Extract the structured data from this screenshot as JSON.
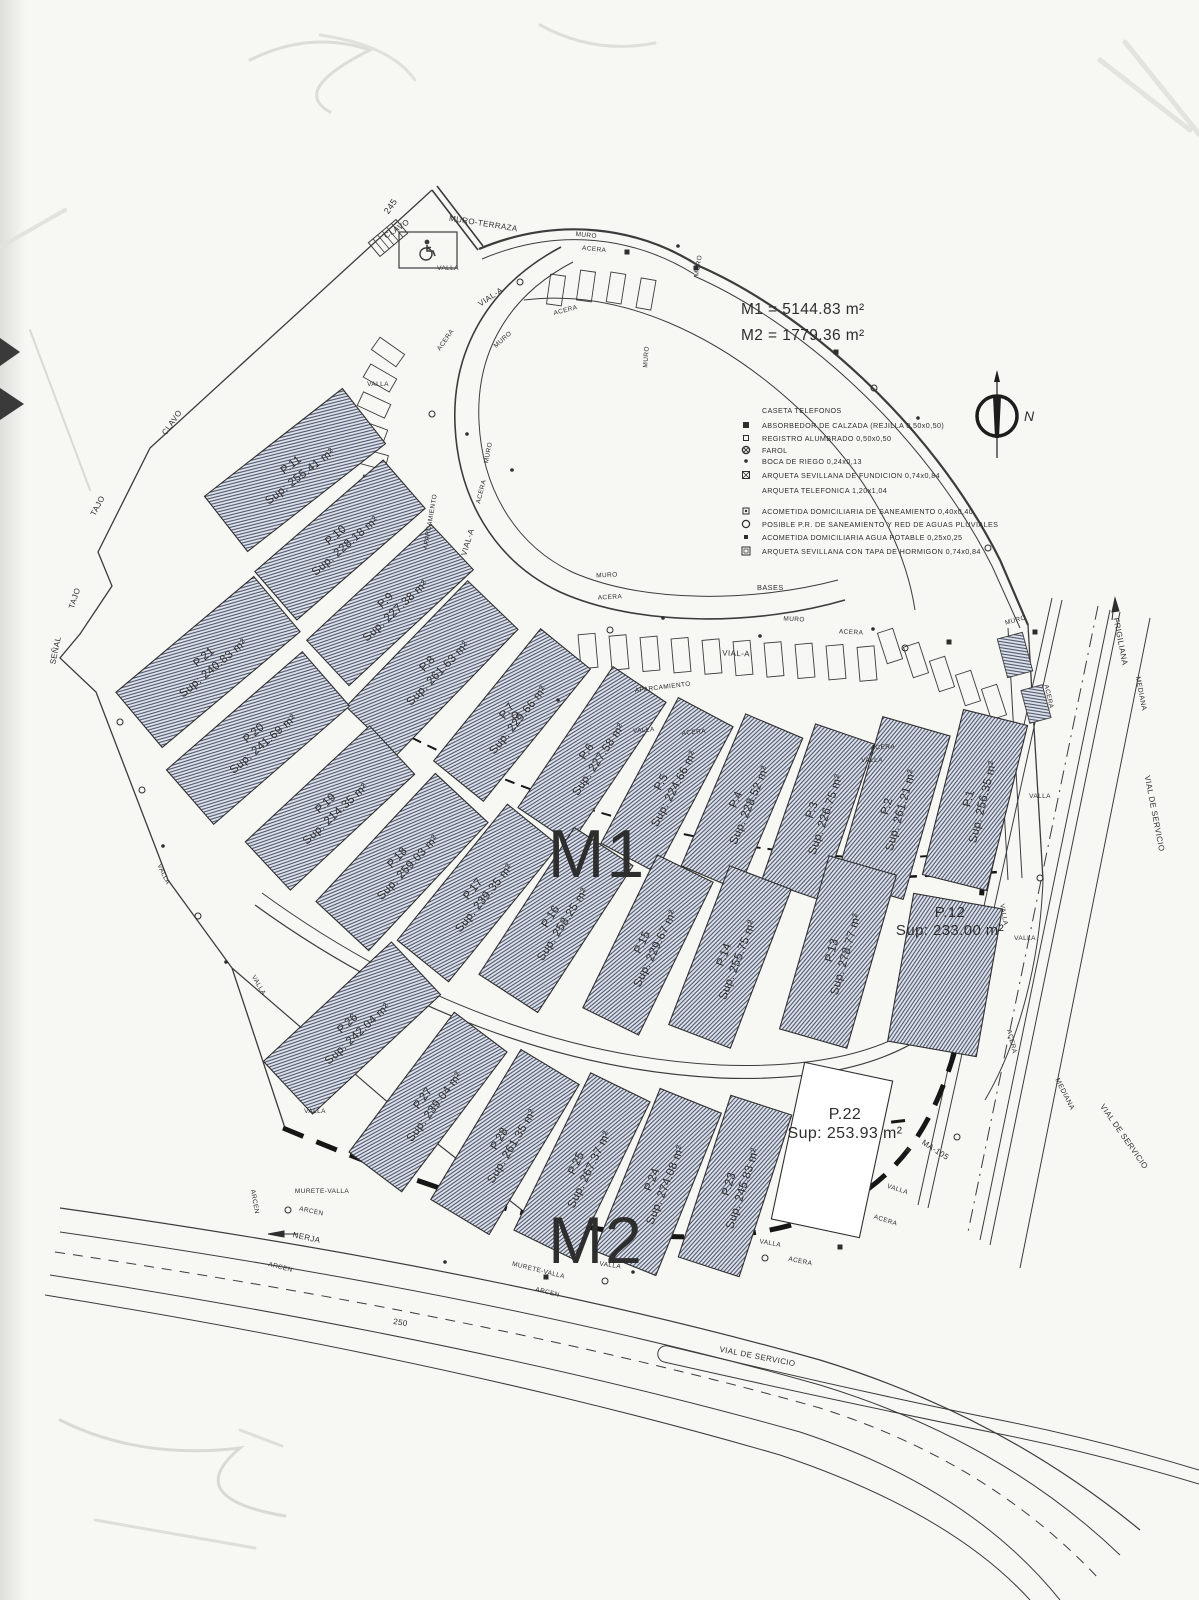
{
  "document": {
    "type_label": "Plano de parcelación (scan)"
  },
  "totals": {
    "m1": "M1 = 5144.83 m²",
    "m2": "M2 = 1779.36 m²"
  },
  "zones": {
    "m1": "M1",
    "m2": "M2"
  },
  "compass": {
    "north_label": "N"
  },
  "legend": {
    "rows": [
      {
        "symbol": "none",
        "label": "CASETA TELEFONOS"
      },
      {
        "symbol": "sq-filled",
        "label": "ABSORBEDOR DE CALZADA (REJILLA 0,50x0,50)"
      },
      {
        "symbol": "sq-open",
        "label": "REGISTRO ALUMBRADO 0,50x0,50"
      },
      {
        "symbol": "lamp",
        "label": "FAROL"
      },
      {
        "symbol": "dot",
        "label": "BOCA DE RIEGO 0,24x0,13"
      },
      {
        "symbol": "sq-x",
        "label": "ARQUETA SEVILLANA DE FUNDICION 0,74x0,84"
      },
      {
        "symbol": "none",
        "label": "ARQUETA TELEFONICA 1,20x1,04"
      },
      {
        "symbol": "sq-dot",
        "label": "ACOMETIDA DOMICILIARIA DE SANEAMIENTO 0,40x0,40"
      },
      {
        "symbol": "circle",
        "label": "POSIBLE P.R. DE SANEAMIENTO Y RED DE AGUAS PLUVIALES"
      },
      {
        "symbol": "sq-sm-filled",
        "label": "ACOMETIDA DOMICILIARIA AGUA POTABLE 0,25x0,25"
      },
      {
        "symbol": "sq-open-lg",
        "label": "ARQUETA SEVILLANA CON TAPA DE HORMIGON 0,74x0,84"
      }
    ],
    "footer": "BASES"
  },
  "parcels": [
    {
      "id": "P.1",
      "zone": "M1",
      "sup": "Sup: 256.35 m²",
      "x": 975,
      "y": 800,
      "rot": -76,
      "len": 170,
      "wid": 66,
      "hatched": true
    },
    {
      "id": "P.2",
      "zone": "M1",
      "sup": "Sup: 261.21 m²",
      "x": 893,
      "y": 808,
      "rot": -74,
      "len": 170,
      "wid": 70,
      "hatched": true
    },
    {
      "id": "P.3",
      "zone": "M1",
      "sup": "Sup: 226.75 m²",
      "x": 818,
      "y": 812,
      "rot": -71,
      "len": 165,
      "wid": 62,
      "hatched": true
    },
    {
      "id": "P.4",
      "zone": "M1",
      "sup": "Sup: 228.52 m²",
      "x": 742,
      "y": 802,
      "rot": -67,
      "len": 165,
      "wid": 62,
      "hatched": true
    },
    {
      "id": "P.5",
      "zone": "M1",
      "sup": "Sup: 224.66 m²",
      "x": 667,
      "y": 785,
      "rot": -62,
      "len": 165,
      "wid": 62,
      "hatched": true
    },
    {
      "id": "P.6",
      "zone": "M1",
      "sup": "Sup: 227.58 m²",
      "x": 592,
      "y": 755,
      "rot": -56,
      "len": 170,
      "wid": 64,
      "hatched": true
    },
    {
      "id": "P.7",
      "zone": "M1",
      "sup": "Sup: 229.66 m²",
      "x": 512,
      "y": 715,
      "rot": -51,
      "len": 170,
      "wid": 64,
      "hatched": true
    },
    {
      "id": "P.8",
      "zone": "M1",
      "sup": "Sup: 261.63 m²",
      "x": 432,
      "y": 668,
      "rot": -46,
      "len": 175,
      "wid": 70,
      "hatched": true
    },
    {
      "id": "P.9",
      "zone": "M1",
      "sup": "Sup: 227.38 m²",
      "x": 390,
      "y": 605,
      "rot": -43,
      "len": 170,
      "wid": 62,
      "hatched": true
    },
    {
      "id": "P.10",
      "zone": "M1",
      "sup": "Sup: 228.18 m²",
      "x": 340,
      "y": 540,
      "rot": -41,
      "len": 170,
      "wid": 64,
      "hatched": true
    },
    {
      "id": "P.11",
      "zone": "M1",
      "sup": "Sup: 255.41 m²",
      "x": 295,
      "y": 470,
      "rot": -38,
      "len": 175,
      "wid": 70,
      "hatched": true
    },
    {
      "id": "P.12",
      "zone": "M1",
      "sup": "Sup: 233.00 m²",
      "x": 945,
      "y": 975,
      "rot": -80,
      "len": 150,
      "wid": 90,
      "hatched": true,
      "lx": 950,
      "ly": 920,
      "lrot": 0,
      "ls": 15
    },
    {
      "id": "P.13",
      "zone": "M1",
      "sup": "Sup: 278.77 m²",
      "x": 838,
      "y": 952,
      "rot": -74,
      "len": 180,
      "wid": 70,
      "hatched": true
    },
    {
      "id": "P.14",
      "zone": "M1",
      "sup": "Sup: 255.75 m²",
      "x": 730,
      "y": 957,
      "rot": -69,
      "len": 170,
      "wid": 66,
      "hatched": true
    },
    {
      "id": "P.15",
      "zone": "M1",
      "sup": "Sup: 229.67 m²",
      "x": 648,
      "y": 945,
      "rot": -64,
      "len": 170,
      "wid": 62,
      "hatched": true
    },
    {
      "id": "P.16",
      "zone": "M1",
      "sup": "Sup: 258.25 m²",
      "x": 556,
      "y": 920,
      "rot": -57,
      "len": 175,
      "wid": 70,
      "hatched": true
    },
    {
      "id": "P.17",
      "zone": "M1",
      "sup": "Sup: 239.35 m²",
      "x": 478,
      "y": 893,
      "rot": -51,
      "len": 175,
      "wid": 66,
      "hatched": true
    },
    {
      "id": "P.18",
      "zone": "M1",
      "sup": "Sup: 259.03 m²",
      "x": 402,
      "y": 862,
      "rot": -47,
      "len": 175,
      "wid": 72,
      "hatched": true
    },
    {
      "id": "P.19",
      "zone": "M1",
      "sup": "Sup: 214.35 m²",
      "x": 330,
      "y": 808,
      "rot": -43,
      "len": 170,
      "wid": 66,
      "hatched": true
    },
    {
      "id": "P.20",
      "zone": "M1",
      "sup": "Sup: 241.69 m²",
      "x": 258,
      "y": 738,
      "rot": -41,
      "len": 180,
      "wid": 72,
      "hatched": true
    },
    {
      "id": "P.21",
      "zone": "M1",
      "sup": "Sup: 240.83 m²",
      "x": 208,
      "y": 662,
      "rot": -40,
      "len": 180,
      "wid": 72,
      "hatched": true
    },
    {
      "id": "P.22",
      "zone": "M2",
      "sup": "Sup: 253.93 m²",
      "x": 832,
      "y": 1150,
      "rot": -78,
      "len": 160,
      "wid": 90,
      "hatched": false,
      "lx": 845,
      "ly": 1122,
      "lrot": 0,
      "ls": 16
    },
    {
      "id": "P.23",
      "zone": "M2",
      "sup": "Sup: 245.83 m²",
      "x": 735,
      "y": 1186,
      "rot": -72,
      "len": 170,
      "wid": 64,
      "hatched": true
    },
    {
      "id": "P.24",
      "zone": "M2",
      "sup": "Sup: 274.08 m²",
      "x": 658,
      "y": 1182,
      "rot": -68,
      "len": 175,
      "wid": 66,
      "hatched": true
    },
    {
      "id": "P.25",
      "zone": "M2",
      "sup": "Sup: 267.37 m²",
      "x": 582,
      "y": 1166,
      "rot": -64,
      "len": 175,
      "wid": 66,
      "hatched": true
    },
    {
      "id": "P.28",
      "zone": "M2",
      "sup": "Sup: 261.35 m²",
      "x": 505,
      "y": 1142,
      "rot": -59,
      "len": 175,
      "wid": 68,
      "hatched": true
    },
    {
      "id": "P.27",
      "zone": "M2",
      "sup": "Sup: 239.04 m²",
      "x": 428,
      "y": 1102,
      "rot": -53,
      "len": 175,
      "wid": 66,
      "hatched": true
    },
    {
      "id": "P.26",
      "zone": "M2",
      "sup": "Sup: 242.04 m²",
      "x": 352,
      "y": 1028,
      "rot": -43,
      "len": 175,
      "wid": 72,
      "hatched": true
    }
  ],
  "street_labels": [
    {
      "t": "245",
      "x": 393,
      "y": 208,
      "r": -55,
      "s": 9
    },
    {
      "t": "MURO-TERRAZA",
      "x": 483,
      "y": 226,
      "r": 9,
      "s": 8
    },
    {
      "t": "CLAVO",
      "x": 398,
      "y": 231,
      "r": -33,
      "s": 8
    },
    {
      "t": "CLAVO",
      "x": 174,
      "y": 424,
      "r": -55,
      "s": 8
    },
    {
      "t": "TAJO",
      "x": 100,
      "y": 507,
      "r": -62,
      "s": 8
    },
    {
      "t": "TAJO",
      "x": 77,
      "y": 599,
      "r": -72,
      "s": 8
    },
    {
      "t": "SEÑAL",
      "x": 58,
      "y": 651,
      "r": -78,
      "s": 8
    },
    {
      "t": "VALLA",
      "x": 448,
      "y": 270,
      "r": 0,
      "s": 6.5
    },
    {
      "t": "MURO",
      "x": 586,
      "y": 237,
      "r": 6,
      "s": 6.5
    },
    {
      "t": "ACERA",
      "x": 594,
      "y": 251,
      "r": 6,
      "s": 6.5
    },
    {
      "t": "VIAL-A",
      "x": 492,
      "y": 299,
      "r": -34,
      "s": 8
    },
    {
      "t": "ACERA",
      "x": 566,
      "y": 312,
      "r": -15,
      "s": 6.5
    },
    {
      "t": "MURO",
      "x": 504,
      "y": 341,
      "r": -42,
      "s": 6.5
    },
    {
      "t": "ACERA",
      "x": 447,
      "y": 341,
      "r": -55,
      "s": 6.5
    },
    {
      "t": "MURO",
      "x": 700,
      "y": 266,
      "r": -80,
      "s": 6.5
    },
    {
      "t": "MURO",
      "x": 648,
      "y": 357,
      "r": -86,
      "s": 6.5
    },
    {
      "t": "VALLA",
      "x": 378,
      "y": 386,
      "r": 0,
      "s": 6.5
    },
    {
      "t": "APARCAMIENTO",
      "x": 432,
      "y": 522,
      "r": -80,
      "s": 6.5
    },
    {
      "t": "VIAL-A",
      "x": 470,
      "y": 543,
      "r": -73,
      "s": 8
    },
    {
      "t": "ACERA",
      "x": 483,
      "y": 492,
      "r": -76,
      "s": 6.5
    },
    {
      "t": "MURO",
      "x": 490,
      "y": 453,
      "r": -79,
      "s": 6.5
    },
    {
      "t": "MURO",
      "x": 607,
      "y": 577,
      "r": -3,
      "s": 6.5
    },
    {
      "t": "ACERA",
      "x": 610,
      "y": 599,
      "r": -3,
      "s": 6.5
    },
    {
      "t": "VIAL-A",
      "x": 736,
      "y": 656,
      "r": 2,
      "s": 8
    },
    {
      "t": "MURO",
      "x": 794,
      "y": 621,
      "r": 3,
      "s": 6.5
    },
    {
      "t": "ACERA",
      "x": 851,
      "y": 634,
      "r": 3,
      "s": 6.5
    },
    {
      "t": "APARCAMIENTO",
      "x": 663,
      "y": 689,
      "r": -7,
      "s": 6.5
    },
    {
      "t": "VALLA",
      "x": 644,
      "y": 732,
      "r": -5,
      "s": 6.5
    },
    {
      "t": "ACERA",
      "x": 694,
      "y": 734,
      "r": -5,
      "s": 6.5
    },
    {
      "t": "ACERA",
      "x": 883,
      "y": 749,
      "r": -3,
      "s": 6.5
    },
    {
      "t": "VALLA",
      "x": 872,
      "y": 762,
      "r": 0,
      "s": 6.5
    },
    {
      "t": "MURO",
      "x": 1016,
      "y": 622,
      "r": -15,
      "s": 6.5
    },
    {
      "t": "ACERA",
      "x": 1047,
      "y": 697,
      "r": 77,
      "s": 6.5
    },
    {
      "t": "VALLA",
      "x": 1040,
      "y": 798,
      "r": 0,
      "s": 6.5
    },
    {
      "t": "FRIGILIANA",
      "x": 1118,
      "y": 642,
      "r": 79,
      "s": 8
    },
    {
      "t": "MEDIANA",
      "x": 1139,
      "y": 694,
      "r": 79,
      "s": 7
    },
    {
      "t": "VIAL DE SERVICIO",
      "x": 1152,
      "y": 814,
      "r": 79,
      "s": 8
    },
    {
      "t": "VALLA",
      "x": 1002,
      "y": 915,
      "r": 80,
      "s": 6.5
    },
    {
      "t": "VALLA",
      "x": 1025,
      "y": 940,
      "r": 0,
      "s": 6.5
    },
    {
      "t": "ACERA",
      "x": 1010,
      "y": 1042,
      "r": 76,
      "s": 6.5
    },
    {
      "t": "MEDIANA",
      "x": 1063,
      "y": 1095,
      "r": 63,
      "s": 7
    },
    {
      "t": "VIAL DE SERVICIO",
      "x": 1122,
      "y": 1138,
      "r": 55,
      "s": 8
    },
    {
      "t": "MA-105",
      "x": 934,
      "y": 1152,
      "r": 33,
      "s": 8
    },
    {
      "t": "VALLA",
      "x": 897,
      "y": 1191,
      "r": 18,
      "s": 6.5
    },
    {
      "t": "ACERA",
      "x": 885,
      "y": 1222,
      "r": 18,
      "s": 6.5
    },
    {
      "t": "VALLA",
      "x": 770,
      "y": 1245,
      "r": 10,
      "s": 6.5
    },
    {
      "t": "ACERA",
      "x": 800,
      "y": 1263,
      "r": 12,
      "s": 6.5
    },
    {
      "t": "VALLA",
      "x": 610,
      "y": 1267,
      "r": 8,
      "s": 6.5
    },
    {
      "t": "VALLA",
      "x": 315,
      "y": 1113,
      "r": 0,
      "s": 6.5
    },
    {
      "t": "VALLA",
      "x": 162,
      "y": 875,
      "r": 65,
      "s": 6.5
    },
    {
      "t": "VALLA",
      "x": 257,
      "y": 986,
      "r": 60,
      "s": 6.5
    },
    {
      "t": "MURETE-VALLA",
      "x": 322,
      "y": 1193,
      "r": 0,
      "s": 6.5
    },
    {
      "t": "ARCEN",
      "x": 311,
      "y": 1213,
      "r": 12,
      "s": 6.5
    },
    {
      "t": "NERJA",
      "x": 306,
      "y": 1240,
      "r": 12,
      "s": 8
    },
    {
      "t": "ARCEN",
      "x": 280,
      "y": 1269,
      "r": 14,
      "s": 6.5
    },
    {
      "t": "ARCEN",
      "x": 253,
      "y": 1202,
      "r": 80,
      "s": 6.5
    },
    {
      "t": "250",
      "x": 400,
      "y": 1325,
      "r": 10,
      "s": 8
    },
    {
      "t": "MURETE-VALLA",
      "x": 538,
      "y": 1272,
      "r": 14,
      "s": 6.5
    },
    {
      "t": "ARCEN",
      "x": 547,
      "y": 1294,
      "r": 14,
      "s": 6.5
    },
    {
      "t": "VIAL DE SERVICIO",
      "x": 757,
      "y": 1359,
      "r": 11,
      "s": 8
    }
  ]
}
